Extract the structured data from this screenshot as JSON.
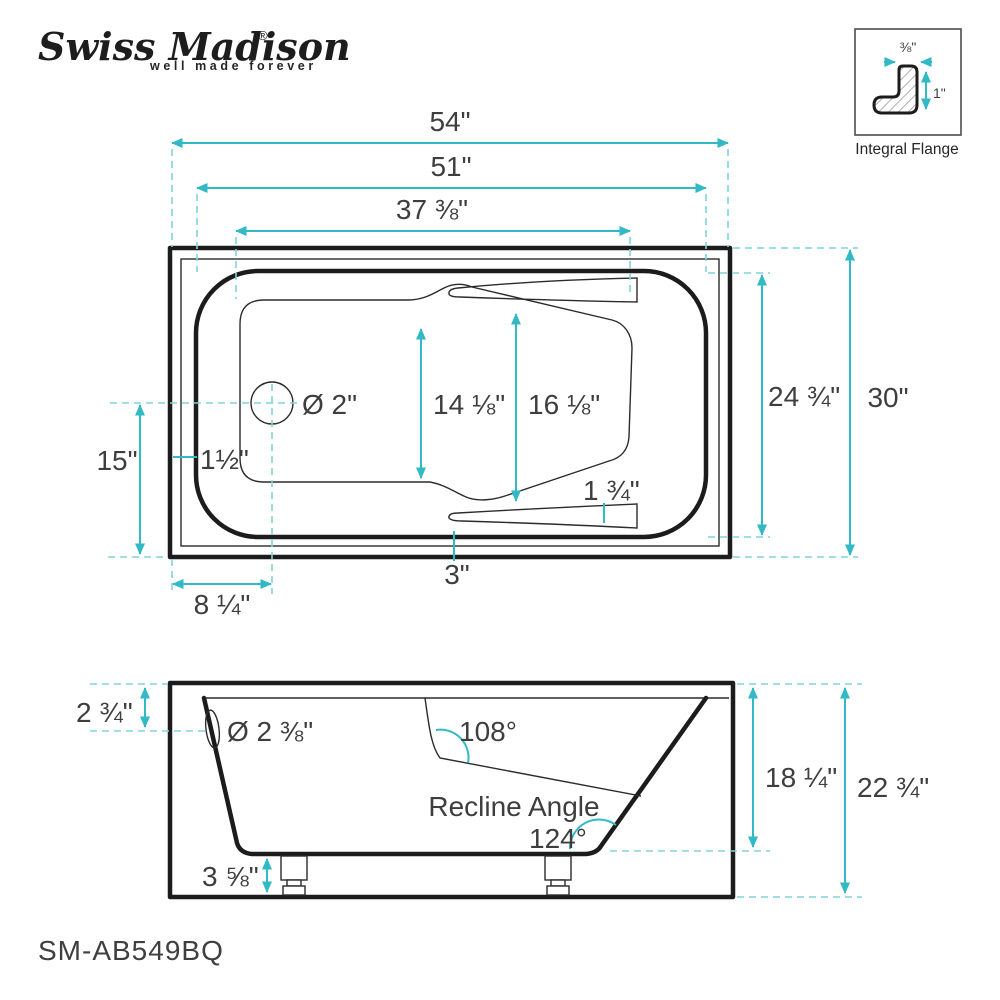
{
  "brand": {
    "name": "Swiss Madison",
    "reg": "®",
    "tagline": "well made forever"
  },
  "flange_detail": {
    "title": "Integral Flange",
    "width_label": "⅜\"",
    "height_label": "1\""
  },
  "top_view": {
    "overall_length": "54\"",
    "deck_length": "51\"",
    "basin_length": "37 ⅜\"",
    "overall_width": "30\"",
    "deck_width": "24 ¾\"",
    "drain_from_edge": "15\"",
    "drain_from_end": "8 ¼\"",
    "rim_offset": "1½\"",
    "drain_diameter": "Ø 2\"",
    "basin_width_foot": "14 ⅛\"",
    "basin_width_back": "16 ⅛\"",
    "armrest_width": "1 ¾\"",
    "skirt_width": "3\""
  },
  "side_view": {
    "deck_to_overflow": "2 ¾\"",
    "overflow_diameter": "Ø 2 ⅜\"",
    "backrest_angle": "108°",
    "recline_label": "Recline Angle",
    "recline_angle": "124°",
    "leg_height": "3 ⅝\"",
    "basin_depth": "18 ¼\"",
    "overall_height": "22 ¾\""
  },
  "model_number": "SM-AB549BQ",
  "colors": {
    "dimension_teal": "#31b9c5",
    "extension_teal": "#7fd4db",
    "line_black": "#1c1c1c",
    "text_gray": "#3e3e3e"
  }
}
